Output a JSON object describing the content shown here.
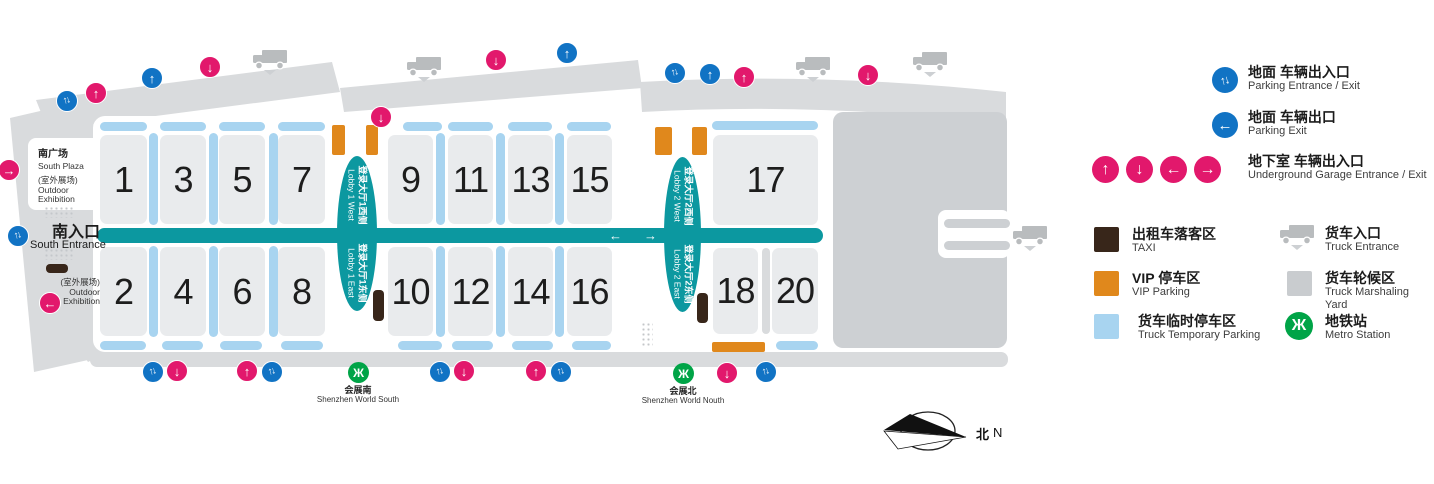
{
  "colors": {
    "teal": "#0c98a0",
    "pink": "#e2186c",
    "blue": "#1173c4",
    "light_blue": "#a8d4f0",
    "hall_gray": "#e9ebed",
    "road_gray": "#d9dbdd",
    "yard_gray": "#cdd0d3",
    "orange": "#e0881c",
    "taxi_brown": "#38261a",
    "metro_green": "#00a447",
    "truck_gray": "#b9bcbe"
  },
  "map": {
    "south_plaza": {
      "zh": "南广场",
      "en": "South Plaza",
      "sub_zh": "(室外展场)",
      "sub_en1": "Outdoor",
      "sub_en2": "Exhibition"
    },
    "south_entrance": {
      "zh": "南入口",
      "en": "South Entrance"
    },
    "outdoor_exhibition_2": {
      "zh": "(室外展场)",
      "en1": "Outdoor",
      "en2": "Exhibition"
    },
    "halls": [
      {
        "label": "1",
        "x": 100,
        "y": 135,
        "w": 47,
        "h": 89
      },
      {
        "label": "3",
        "x": 160,
        "y": 135,
        "w": 46,
        "h": 89
      },
      {
        "label": "5",
        "x": 219,
        "y": 135,
        "w": 46,
        "h": 89
      },
      {
        "label": "7",
        "x": 278,
        "y": 135,
        "w": 47,
        "h": 89
      },
      {
        "label": "2",
        "x": 100,
        "y": 247,
        "w": 47,
        "h": 89
      },
      {
        "label": "4",
        "x": 160,
        "y": 247,
        "w": 46,
        "h": 89
      },
      {
        "label": "6",
        "x": 219,
        "y": 247,
        "w": 46,
        "h": 89
      },
      {
        "label": "8",
        "x": 278,
        "y": 247,
        "w": 47,
        "h": 89
      },
      {
        "label": "9",
        "x": 388,
        "y": 135,
        "w": 45,
        "h": 89
      },
      {
        "label": "11",
        "x": 448,
        "y": 135,
        "w": 45,
        "h": 89
      },
      {
        "label": "13",
        "x": 508,
        "y": 135,
        "w": 45,
        "h": 89
      },
      {
        "label": "15",
        "x": 567,
        "y": 135,
        "w": 45,
        "h": 89
      },
      {
        "label": "10",
        "x": 388,
        "y": 247,
        "w": 45,
        "h": 89
      },
      {
        "label": "12",
        "x": 448,
        "y": 247,
        "w": 45,
        "h": 89
      },
      {
        "label": "14",
        "x": 508,
        "y": 247,
        "w": 45,
        "h": 89
      },
      {
        "label": "16",
        "x": 567,
        "y": 247,
        "w": 45,
        "h": 89
      },
      {
        "label": "17",
        "x": 713,
        "y": 135,
        "w": 105,
        "h": 90
      },
      {
        "label": "18",
        "x": 713,
        "y": 248,
        "w": 45,
        "h": 86
      },
      {
        "label": "20",
        "x": 772,
        "y": 248,
        "w": 46,
        "h": 86
      }
    ],
    "truck_parking_strips": {
      "vertical": [
        {
          "x": 149,
          "y": 133,
          "h": 92
        },
        {
          "x": 209,
          "y": 133,
          "h": 92
        },
        {
          "x": 269,
          "y": 133,
          "h": 92
        },
        {
          "x": 436,
          "y": 133,
          "h": 92
        },
        {
          "x": 496,
          "y": 133,
          "h": 92
        },
        {
          "x": 555,
          "y": 133,
          "h": 92
        },
        {
          "x": 149,
          "y": 246,
          "h": 91
        },
        {
          "x": 209,
          "y": 246,
          "h": 91
        },
        {
          "x": 269,
          "y": 246,
          "h": 91
        },
        {
          "x": 436,
          "y": 246,
          "h": 91
        },
        {
          "x": 496,
          "y": 246,
          "h": 91
        },
        {
          "x": 555,
          "y": 246,
          "h": 91
        }
      ],
      "horizontal": [
        {
          "x": 100,
          "y": 122,
          "w": 47
        },
        {
          "x": 160,
          "y": 122,
          "w": 46
        },
        {
          "x": 219,
          "y": 122,
          "w": 46
        },
        {
          "x": 278,
          "y": 122,
          "w": 47
        },
        {
          "x": 403,
          "y": 122,
          "w": 39
        },
        {
          "x": 448,
          "y": 122,
          "w": 45
        },
        {
          "x": 508,
          "y": 122,
          "w": 44
        },
        {
          "x": 567,
          "y": 122,
          "w": 44
        },
        {
          "x": 712,
          "y": 121,
          "w": 106
        },
        {
          "x": 100,
          "y": 341,
          "w": 46
        },
        {
          "x": 162,
          "y": 341,
          "w": 41
        },
        {
          "x": 220,
          "y": 341,
          "w": 42
        },
        {
          "x": 281,
          "y": 341,
          "w": 42
        },
        {
          "x": 398,
          "y": 341,
          "w": 44
        },
        {
          "x": 452,
          "y": 341,
          "w": 41
        },
        {
          "x": 512,
          "y": 341,
          "w": 41
        },
        {
          "x": 572,
          "y": 341,
          "w": 39
        },
        {
          "x": 776,
          "y": 341,
          "w": 42
        }
      ]
    },
    "vip_areas": [
      {
        "x": 332,
        "y": 125,
        "w": 13,
        "h": 30
      },
      {
        "x": 366,
        "y": 125,
        "w": 12,
        "h": 30
      },
      {
        "x": 655,
        "y": 127,
        "w": 17,
        "h": 28
      },
      {
        "x": 692,
        "y": 127,
        "w": 15,
        "h": 28
      },
      {
        "x": 712,
        "y": 342,
        "w": 53,
        "h": 10
      }
    ],
    "taxi_areas": [
      {
        "x": 373,
        "y": 290,
        "w": 11,
        "h": 31
      },
      {
        "x": 697,
        "y": 293,
        "w": 11,
        "h": 30
      },
      {
        "x": 46,
        "y": 264,
        "w": 22,
        "h": 9
      }
    ],
    "corridor": {
      "x": 97,
      "y": 228,
      "w": 726,
      "h": 15,
      "arrows": [
        {
          "ch": "←",
          "x": 609
        },
        {
          "ch": "→",
          "x": 644
        }
      ]
    },
    "lobbies": [
      {
        "x": 337,
        "y": 156,
        "w": 40,
        "h": 155,
        "west_zh": "登录大厅1西侧",
        "west_en": "Lobby 1 West",
        "east_zh": "登录大厅1东侧",
        "east_en": "Lobby 1 East"
      },
      {
        "x": 664,
        "y": 157,
        "w": 37,
        "h": 155,
        "west_zh": "登录大厅2西侧",
        "west_en": "Lobby 2 West",
        "east_zh": "登录大厅2东侧",
        "east_en": "Lobby 2 East"
      }
    ],
    "icons": [
      {
        "t": "parking-two-way",
        "x": 67,
        "y": 101
      },
      {
        "t": "garage-up",
        "x": 96,
        "y": 93
      },
      {
        "t": "parking-up",
        "x": 152,
        "y": 78
      },
      {
        "t": "garage-down",
        "x": 210,
        "y": 67
      },
      {
        "t": "garage-down",
        "x": 381,
        "y": 117
      },
      {
        "t": "garage-down",
        "x": 496,
        "y": 60
      },
      {
        "t": "parking-up",
        "x": 567,
        "y": 53
      },
      {
        "t": "parking-two-way",
        "x": 675,
        "y": 73
      },
      {
        "t": "parking-up",
        "x": 710,
        "y": 74
      },
      {
        "t": "garage-up",
        "x": 744,
        "y": 77
      },
      {
        "t": "garage-down",
        "x": 868,
        "y": 75
      },
      {
        "t": "garage-right",
        "x": 9,
        "y": 170
      },
      {
        "t": "parking-two-way",
        "x": 18,
        "y": 236
      },
      {
        "t": "garage-left",
        "x": 50,
        "y": 303
      },
      {
        "t": "parking-two-way",
        "x": 153,
        "y": 372
      },
      {
        "t": "garage-down",
        "x": 177,
        "y": 371
      },
      {
        "t": "garage-up",
        "x": 247,
        "y": 371
      },
      {
        "t": "parking-two-way",
        "x": 272,
        "y": 372
      },
      {
        "t": "parking-two-way",
        "x": 440,
        "y": 372
      },
      {
        "t": "garage-down",
        "x": 464,
        "y": 371
      },
      {
        "t": "garage-up",
        "x": 536,
        "y": 371
      },
      {
        "t": "parking-two-way",
        "x": 561,
        "y": 372
      },
      {
        "t": "garage-down",
        "x": 727,
        "y": 373
      },
      {
        "t": "parking-two-way",
        "x": 766,
        "y": 372
      }
    ],
    "trucks": [
      {
        "x": 270,
        "y": 60
      },
      {
        "x": 424,
        "y": 67
      },
      {
        "x": 813,
        "y": 67
      },
      {
        "x": 930,
        "y": 62
      },
      {
        "x": 1030,
        "y": 236
      }
    ],
    "metro_stations": [
      {
        "x": 358,
        "y": 372,
        "zh": "会展南",
        "en": "Shenzhen World South"
      },
      {
        "x": 683,
        "y": 373,
        "zh": "会展北",
        "en": "Shenzhen World Nouth"
      }
    ]
  },
  "legend": {
    "arrow_rows": [
      {
        "zh": "地面 车辆出入口",
        "en": "Parking Entrance / Exit"
      },
      {
        "zh": "地面 车辆出口",
        "en": "Parking Exit"
      },
      {
        "zh": "地下室 车辆出入口",
        "en": "Underground Garage Entrance / Exit"
      }
    ],
    "area_rows": [
      {
        "zh": "出租车落客区",
        "en": "TAXI"
      },
      {
        "zh": "VIP 停车区",
        "en": "VIP Parking"
      },
      {
        "zh": "货车临时停车区",
        "en": "Truck Temporary Parking"
      },
      {
        "zh": "货车入口",
        "en": "Truck Entrance"
      },
      {
        "zh": "货车轮候区",
        "en": "Truck Marshaling Yard"
      },
      {
        "zh": "地铁站",
        "en": "Metro Station"
      }
    ]
  },
  "compass": {
    "zh": "北",
    "en": "N"
  }
}
